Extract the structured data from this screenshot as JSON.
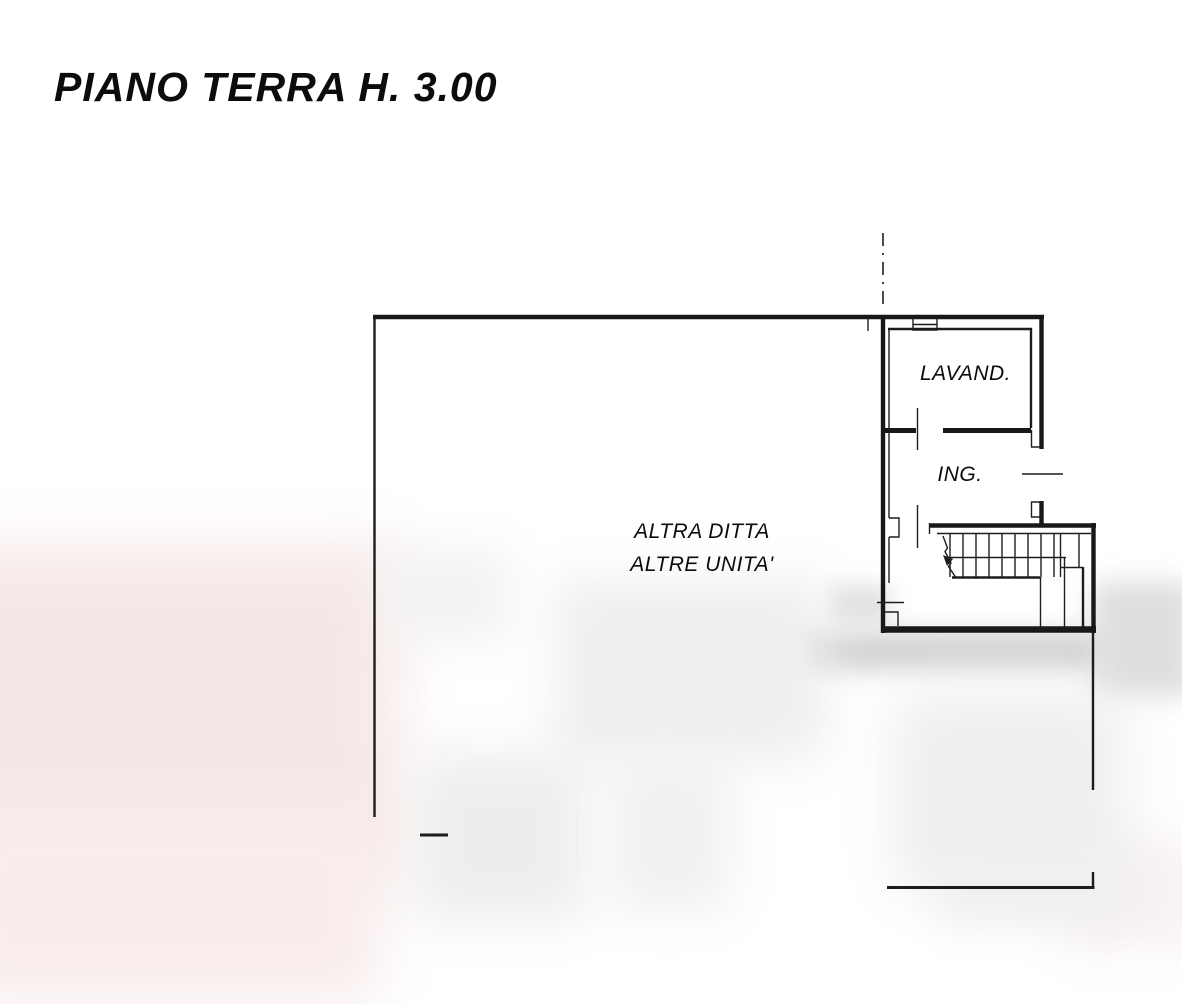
{
  "title": "PIANO TERRA H. 3.00",
  "rooms": {
    "laundry_label": "LAVAND.",
    "entrance_label": "ING.",
    "other_area_line1": "ALTRA DITTA",
    "other_area_line2": "ALTRE UNITA'"
  },
  "colors": {
    "line": "#1c1c1c",
    "background": "#ffffff",
    "smudge_grey": "#d6d6d6",
    "smudge_pink": "#f6e7e7"
  }
}
